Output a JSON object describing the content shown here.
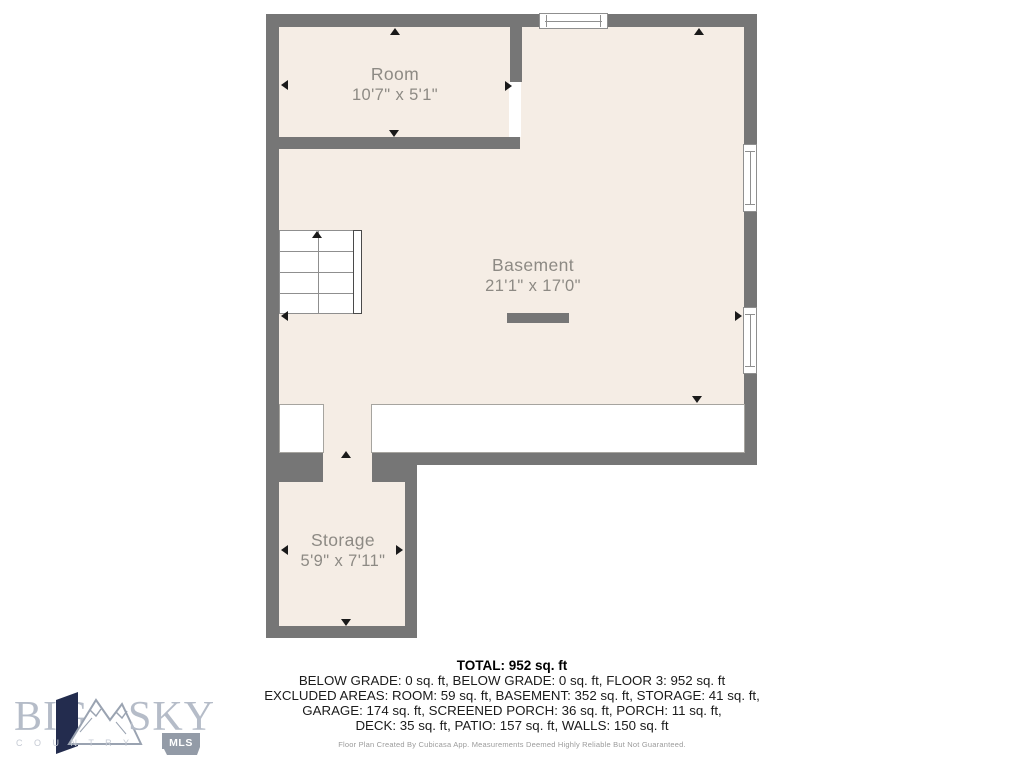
{
  "plan": {
    "rooms": {
      "room": {
        "name": "Room",
        "dims": "10'7\" x 5'1\""
      },
      "basement": {
        "name": "Basement",
        "dims": "21'1\" x 17'0\""
      },
      "storage": {
        "name": "Storage",
        "dims": "5'9\" x 7'11\""
      }
    }
  },
  "summary": {
    "total": "TOTAL: 952 sq. ft",
    "line1": "BELOW GRADE: 0 sq. ft, BELOW GRADE: 0 sq. ft, FLOOR 3: 952 sq. ft",
    "line2": "EXCLUDED AREAS: ROOM: 59 sq. ft, BASEMENT: 352 sq. ft, STORAGE: 41 sq. ft,",
    "line3": "GARAGE: 174 sq. ft, SCREENED PORCH: 36 sq. ft, PORCH: 11 sq. ft,",
    "line4": "DECK: 35 sq. ft, PATIO: 157 sq. ft, WALLS: 150 sq. ft",
    "disclaimer": "Floor Plan Created By Cubicasa App. Measurements Deemed Highly Reliable But Not Guaranteed."
  },
  "logo": {
    "word1": "BIG",
    "word2": "SKY",
    "subtitle": "C O U N T R Y",
    "badge": "MLS"
  },
  "colors": {
    "wall": "#767676",
    "floor": "#f5ede5",
    "label_text": "#8d8a84",
    "arrow": "#1a1a1a",
    "logo_letters": "#b5bcc8",
    "logo_ribbon": "#232c4e",
    "logo_badge": "#939ba7"
  }
}
